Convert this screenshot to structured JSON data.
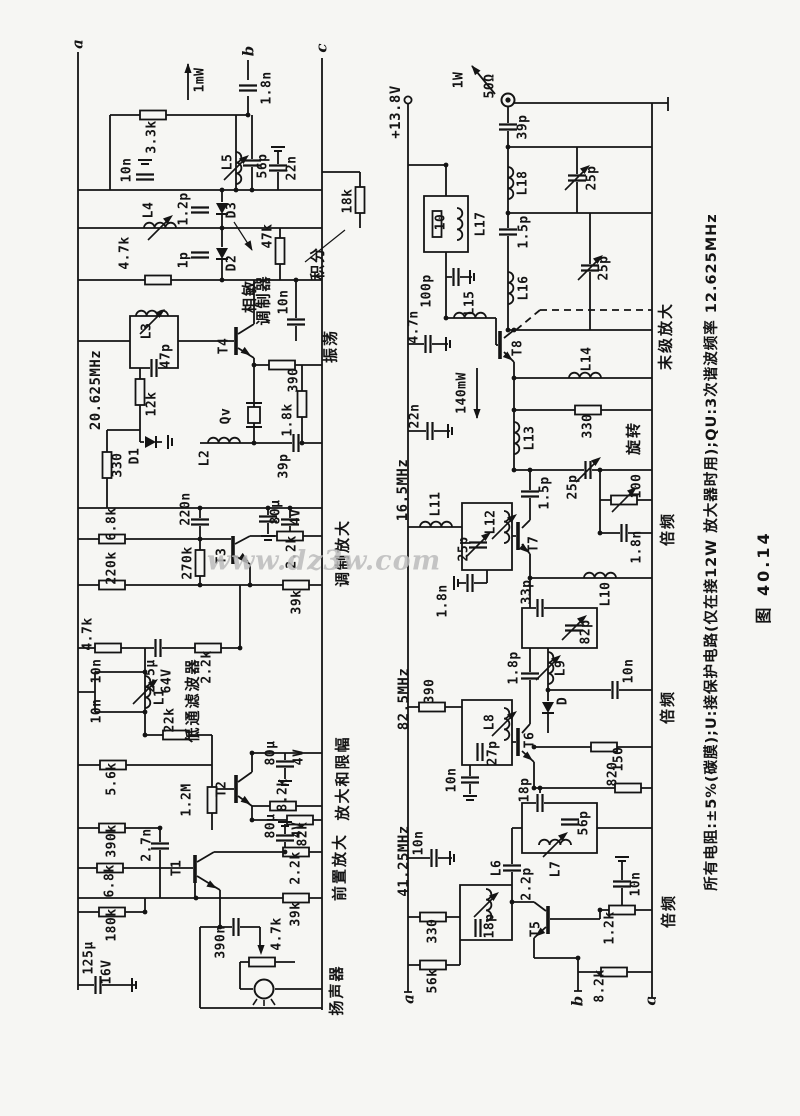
{
  "meta": {
    "watermark": "www.dz3w.com",
    "caption": "图 40.14",
    "note": "所有电阻:±5%(碳膜);U:接保护电路(仅在接12W 放大器时用);QU:3次谐波频率 12.625MHz"
  },
  "circuit": {
    "supply": "+13.8V",
    "output_load": "50Ω",
    "output_power": "1W",
    "intermediate_power": [
      "1mW",
      "140mW"
    ],
    "frequencies": [
      "20.625MHz",
      "41.25MHz",
      "82.5MHz",
      "16.5MHz",
      "12.625MHz"
    ],
    "left_sections": [
      "扬声器",
      "前置放大",
      "放大和限幅",
      "低通滤波器",
      "调制放大",
      "振荡",
      "相敏调制器",
      "积分"
    ],
    "right_sections": [
      "倍频",
      "倍频",
      "倍频",
      "末级放大",
      "旋转"
    ],
    "transistors": [
      "T1",
      "T2",
      "T3",
      "T4",
      "T5",
      "T6",
      "T7",
      "T8"
    ],
    "diodes": [
      "D1",
      "D2",
      "D3",
      "D"
    ],
    "crystal": "Qv",
    "terminals_left": [
      "a",
      "b",
      "c"
    ],
    "terminals_right": [
      "a",
      "b",
      "c"
    ]
  },
  "labels": [
    [
      "a",
      78,
      44,
      "term"
    ],
    [
      "1mW",
      200,
      80,
      "v"
    ],
    [
      "b",
      249,
      51,
      "term"
    ],
    [
      "1.8n",
      267,
      88,
      "v"
    ],
    [
      "c",
      322,
      48,
      "term"
    ],
    [
      "3.3k",
      152,
      137,
      "v"
    ],
    [
      "10n",
      127,
      170,
      "v"
    ],
    [
      "L4",
      149,
      210,
      "v"
    ],
    [
      "1.2p",
      184,
      209,
      "v"
    ],
    [
      "4.7k",
      125,
      253,
      "v"
    ],
    [
      "1p",
      184,
      260,
      "v"
    ],
    [
      "L5",
      228,
      162,
      "v"
    ],
    [
      "56p",
      263,
      166,
      "v"
    ],
    [
      "22n",
      292,
      168,
      "v"
    ],
    [
      "D3",
      232,
      210,
      "v"
    ],
    [
      "D2",
      232,
      263,
      "v"
    ],
    [
      "47k",
      268,
      236,
      "v"
    ],
    [
      "相敏",
      250,
      296,
      "sec"
    ],
    [
      "调制器",
      264,
      300,
      "sec"
    ],
    [
      "积分",
      318,
      263,
      "sec"
    ],
    [
      "18k",
      348,
      201,
      "v"
    ],
    [
      "20.625MHz",
      96,
      390,
      "freq"
    ],
    [
      "L3",
      147,
      331,
      "v"
    ],
    [
      "47p",
      166,
      356,
      "v"
    ],
    [
      "12k",
      152,
      404,
      "v"
    ],
    [
      "D1",
      135,
      456,
      "v"
    ],
    [
      "330",
      118,
      465,
      "v"
    ],
    [
      "T4",
      224,
      346,
      "v"
    ],
    [
      "390",
      294,
      380,
      "v"
    ],
    [
      "振荡",
      331,
      346,
      "sec"
    ],
    [
      "Qv",
      226,
      416,
      "v"
    ],
    [
      "L2",
      205,
      458,
      "v"
    ],
    [
      "39p",
      284,
      466,
      "v"
    ],
    [
      "1.8k",
      288,
      420,
      "v"
    ],
    [
      "10n",
      284,
      302,
      "v"
    ],
    [
      "220n",
      186,
      509,
      "v"
    ],
    [
      "80μ",
      276,
      512,
      "v"
    ],
    [
      "4V",
      296,
      517,
      "v"
    ],
    [
      "6.8k",
      112,
      524,
      "v"
    ],
    [
      "220k",
      112,
      568,
      "v"
    ],
    [
      "270k",
      188,
      563,
      "v"
    ],
    [
      "T3",
      222,
      556,
      "v"
    ],
    [
      "2.2k",
      292,
      552,
      "v"
    ],
    [
      "39k",
      297,
      602,
      "v"
    ],
    [
      "调制放大",
      343,
      553,
      "sec"
    ],
    [
      "4.7k",
      88,
      634,
      "v"
    ],
    [
      "2.5μ",
      151,
      676,
      "v"
    ],
    [
      "64V",
      167,
      681,
      "v"
    ],
    [
      "2.2k",
      207,
      667,
      "v"
    ],
    [
      "10n",
      97,
      671,
      "v"
    ],
    [
      "10n",
      97,
      711,
      "v"
    ],
    [
      "L1",
      160,
      697,
      "v"
    ],
    [
      "22k",
      170,
      720,
      "v"
    ],
    [
      "低通滤波器",
      193,
      700,
      "sec"
    ],
    [
      "5.6k",
      112,
      779,
      "v"
    ],
    [
      "1.2M",
      187,
      800,
      "v"
    ],
    [
      "T2",
      222,
      789,
      "v"
    ],
    [
      "80μ",
      271,
      753,
      "v"
    ],
    [
      "4V",
      299,
      757,
      "v"
    ],
    [
      "8.2k",
      283,
      795,
      "v"
    ],
    [
      "82k",
      303,
      834,
      "v"
    ],
    [
      "放大和限幅",
      343,
      778,
      "sec"
    ],
    [
      "390k",
      112,
      841,
      "v"
    ],
    [
      "2.7n",
      147,
      845,
      "v"
    ],
    [
      "6.8k",
      110,
      881,
      "v"
    ],
    [
      "T1",
      177,
      868,
      "v"
    ],
    [
      "2.2k",
      296,
      868,
      "v"
    ],
    [
      "39k",
      296,
      914,
      "v"
    ],
    [
      "80μ",
      271,
      826,
      "v"
    ],
    [
      "4V",
      298,
      830,
      "v"
    ],
    [
      "前置放大",
      340,
      867,
      "sec"
    ],
    [
      "180k",
      112,
      925,
      "v"
    ],
    [
      "390n",
      221,
      942,
      "v"
    ],
    [
      "4.7k",
      277,
      934,
      "v"
    ],
    [
      "125μ",
      89,
      958,
      "v"
    ],
    [
      "16V",
      107,
      972,
      "v"
    ],
    [
      "扬声器",
      337,
      990,
      "sec"
    ],
    [
      "+13.8V",
      396,
      112,
      "freq"
    ],
    [
      "1W",
      459,
      80,
      "v"
    ],
    [
      "50Ω",
      490,
      86,
      "v"
    ],
    [
      "39p",
      523,
      127,
      "v"
    ],
    [
      "L18",
      523,
      183,
      "v"
    ],
    [
      "25p",
      592,
      178,
      "v"
    ],
    [
      "1.5p",
      524,
      232,
      "v"
    ],
    [
      "10",
      441,
      222,
      "v"
    ],
    [
      "L17",
      481,
      224,
      "v"
    ],
    [
      "L16",
      524,
      288,
      "v"
    ],
    [
      "25p",
      604,
      268,
      "v"
    ],
    [
      "100p",
      427,
      291,
      "v"
    ],
    [
      "L15",
      470,
      303,
      "v"
    ],
    [
      "4.7n",
      414,
      327,
      "v"
    ],
    [
      "T8",
      518,
      348,
      "v"
    ],
    [
      "L14",
      587,
      359,
      "v"
    ],
    [
      "140mW",
      462,
      393,
      "v"
    ],
    [
      "末级放大",
      666,
      336,
      "sec"
    ],
    [
      "22n",
      415,
      416,
      "v"
    ],
    [
      "L13",
      530,
      438,
      "v"
    ],
    [
      "330",
      588,
      426,
      "v"
    ],
    [
      "旋转",
      634,
      438,
      "sec"
    ],
    [
      "25p",
      573,
      487,
      "v"
    ],
    [
      "100",
      637,
      486,
      "v"
    ],
    [
      "1.8n",
      637,
      547,
      "v"
    ],
    [
      "16.5MHz",
      403,
      490,
      "freq"
    ],
    [
      "L11",
      436,
      504,
      "v"
    ],
    [
      "L12",
      491,
      522,
      "v"
    ],
    [
      "25p",
      464,
      549,
      "v"
    ],
    [
      "1.8n",
      443,
      601,
      "v"
    ],
    [
      "1.5p",
      545,
      493,
      "v"
    ],
    [
      "T7",
      534,
      544,
      "v"
    ],
    [
      "33p",
      527,
      592,
      "v"
    ],
    [
      "82p",
      586,
      632,
      "v"
    ],
    [
      "L10",
      606,
      594,
      "v"
    ],
    [
      "倍频",
      668,
      529,
      "sec"
    ],
    [
      "82.5MHz",
      404,
      699,
      "freq"
    ],
    [
      "390",
      430,
      691,
      "v"
    ],
    [
      "L8",
      490,
      722,
      "v"
    ],
    [
      "27p",
      493,
      753,
      "v"
    ],
    [
      "10n",
      452,
      780,
      "v"
    ],
    [
      "1.8p",
      514,
      668,
      "v"
    ],
    [
      "L9",
      561,
      668,
      "v"
    ],
    [
      "D",
      563,
      701,
      "v"
    ],
    [
      "10n",
      629,
      671,
      "v"
    ],
    [
      "T6",
      530,
      740,
      "v"
    ],
    [
      "18p",
      525,
      790,
      "v"
    ],
    [
      "150",
      619,
      759,
      "v"
    ],
    [
      "820",
      613,
      774,
      "v"
    ],
    [
      "倍频",
      668,
      707,
      "sec"
    ],
    [
      "41.25MHz",
      404,
      861,
      "freq"
    ],
    [
      "10n",
      419,
      843,
      "v"
    ],
    [
      "L6",
      497,
      868,
      "v"
    ],
    [
      "18p",
      490,
      926,
      "v"
    ],
    [
      "2.2p",
      527,
      884,
      "v"
    ],
    [
      "L7",
      556,
      869,
      "v"
    ],
    [
      "56p",
      584,
      823,
      "v"
    ],
    [
      "330",
      433,
      931,
      "v"
    ],
    [
      "56k",
      433,
      981,
      "v"
    ],
    [
      "T5",
      536,
      929,
      "v"
    ],
    [
      "10n",
      636,
      884,
      "v"
    ],
    [
      "1.2k",
      610,
      928,
      "v"
    ],
    [
      "8.2k",
      600,
      986,
      "v"
    ],
    [
      "倍频",
      669,
      911,
      "sec"
    ],
    [
      "a",
      409,
      999,
      "term"
    ],
    [
      "b",
      578,
      1001,
      "term"
    ],
    [
      "c",
      651,
      1001,
      "term"
    ]
  ]
}
